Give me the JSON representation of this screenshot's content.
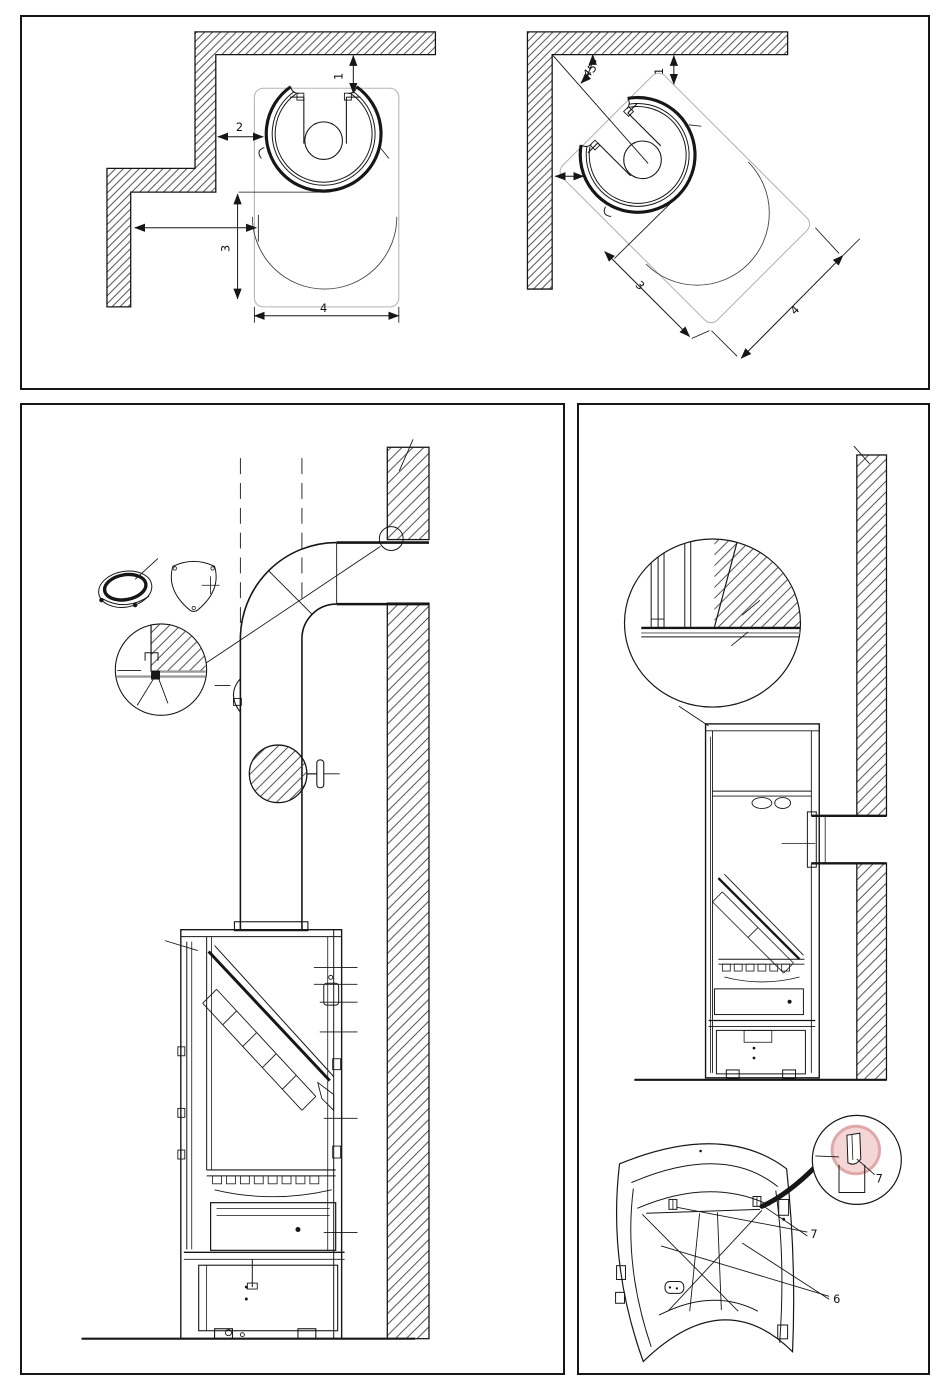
{
  "page": {
    "background": "#ffffff",
    "line_color": "#161616"
  },
  "colors": {
    "hatch_line": "#3c3c3c",
    "plate_outline": "#b5b5b5",
    "extension_gray": "#a8a8a8",
    "highlight_fill": "#f5d6d6",
    "highlight_ring": "#dfa9a9"
  },
  "plan_straight": {
    "dim_rear": "1",
    "dim_side": "2",
    "dim_front": "3",
    "dim_width": "4"
  },
  "plan_corner": {
    "angle": "45°",
    "dim_rear": "1",
    "dim_front": "3",
    "dim_width": "4"
  },
  "door_view": {
    "callout_heat_shields": "6",
    "callout_clips": "7",
    "callout_clip_detail": "7"
  }
}
